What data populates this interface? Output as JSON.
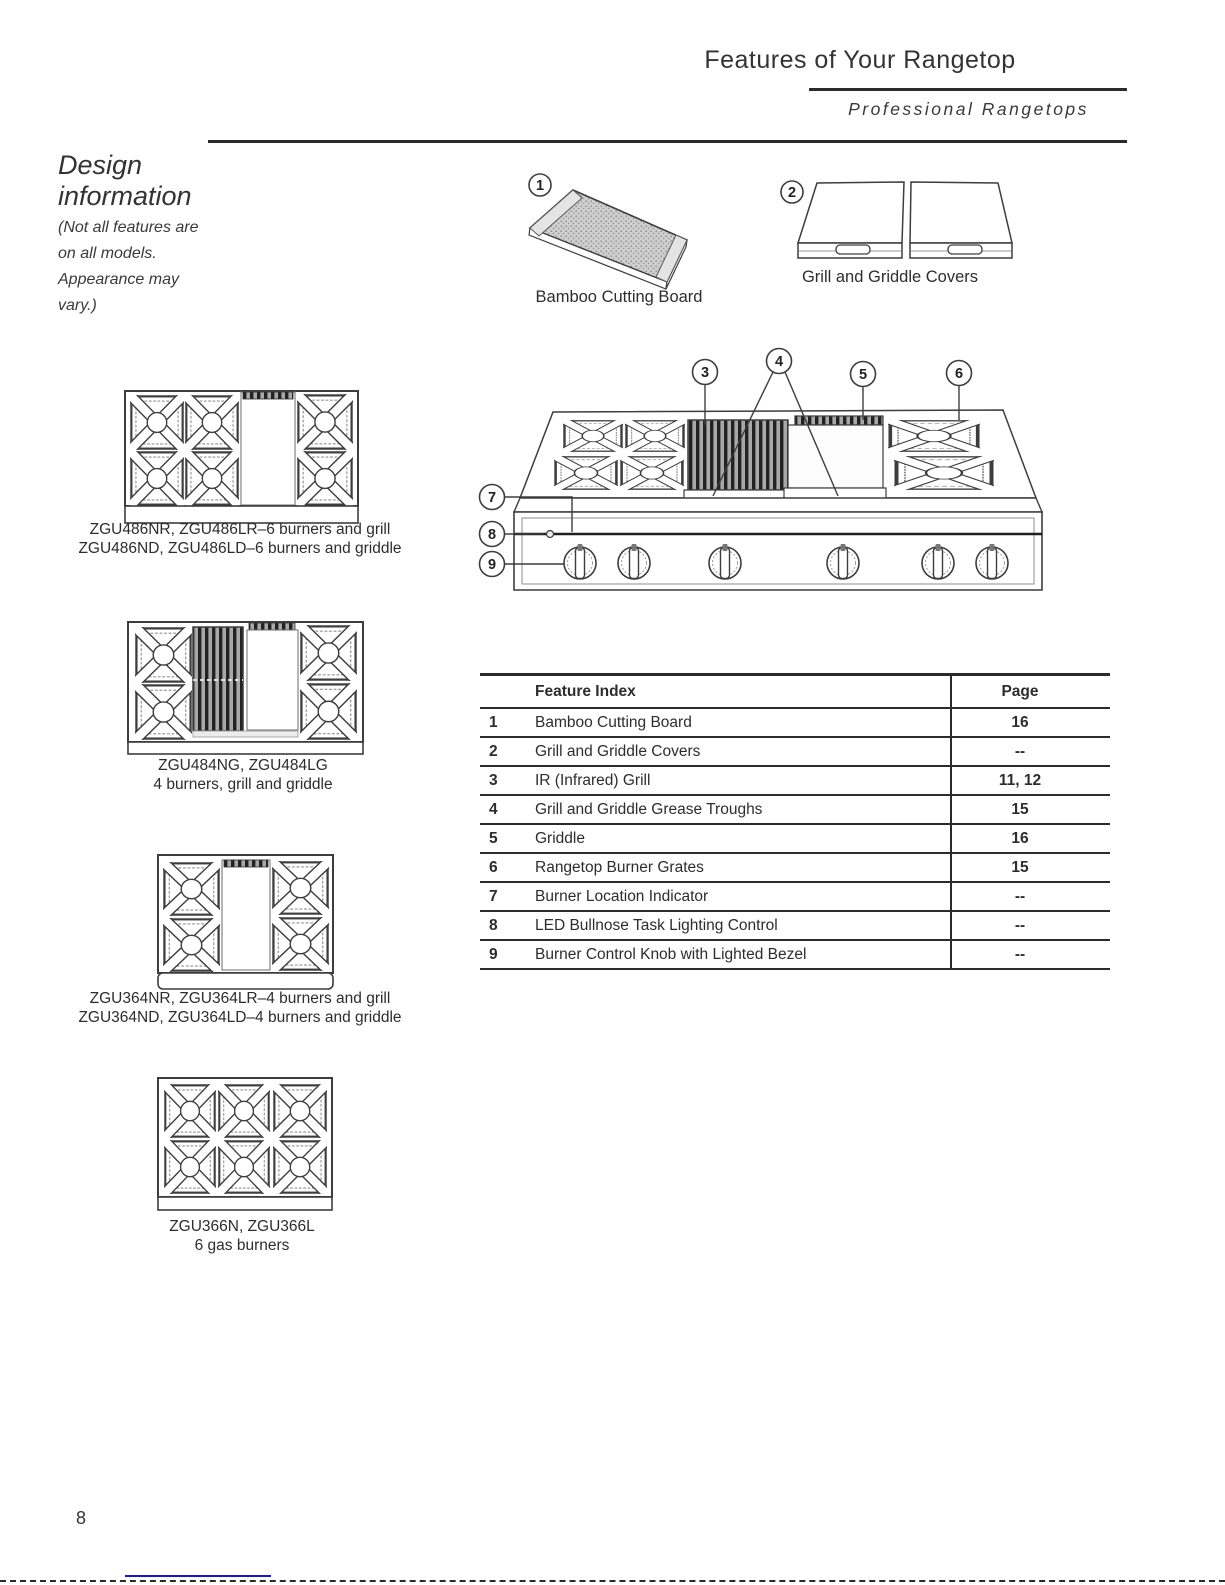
{
  "header": {
    "title": "Features of Your Rangetop",
    "subtitle": "Professional Rangetops"
  },
  "design_info": {
    "heading": "Design information",
    "note": "(Not all features are on all models. Appearance may vary.)"
  },
  "accessories": {
    "cutting_board": {
      "callout": "1",
      "caption": "Bamboo Cutting Board"
    },
    "covers": {
      "callout": "2",
      "caption": "Grill and Griddle Covers"
    }
  },
  "main_diagram": {
    "callouts": {
      "c3": "3",
      "c4": "4",
      "c5": "5",
      "c6": "6",
      "c7": "7",
      "c8": "8",
      "c9": "9"
    }
  },
  "models": [
    {
      "line1": "ZGU486NR, ZGU486LR–6 burners and grill",
      "line2": "ZGU486ND, ZGU486LD–6 burners and griddle"
    },
    {
      "line1": "ZGU484NG, ZGU484LG",
      "line2": "4 burners, grill and griddle"
    },
    {
      "line1": "ZGU364NR, ZGU364LR–4 burners and grill",
      "line2": "ZGU364ND, ZGU364LD–4 burners and griddle"
    },
    {
      "line1": "ZGU366N, ZGU366L",
      "line2": "6 gas burners"
    }
  ],
  "feature_table": {
    "header_feature": "Feature Index",
    "header_page": "Page",
    "rows": [
      {
        "num": "1",
        "feature": "Bamboo Cutting Board",
        "page": "16"
      },
      {
        "num": "2",
        "feature": "Grill and Griddle Covers",
        "page": "--"
      },
      {
        "num": "3",
        "feature": "IR (Infrared) Grill",
        "page": "11, 12"
      },
      {
        "num": "4",
        "feature": "Grill and Griddle Grease Troughs",
        "page": "15"
      },
      {
        "num": "5",
        "feature": "Griddle",
        "page": "16"
      },
      {
        "num": "6",
        "feature": "Rangetop Burner Grates",
        "page": "15"
      },
      {
        "num": "7",
        "feature": "Burner Location Indicator",
        "page": "--"
      },
      {
        "num": "8",
        "feature": "LED Bullnose Task Lighting Control",
        "page": "--"
      },
      {
        "num": "9",
        "feature": "Burner Control Knob with Lighted Bezel",
        "page": "--"
      }
    ]
  },
  "footer": {
    "page_number": "8"
  }
}
